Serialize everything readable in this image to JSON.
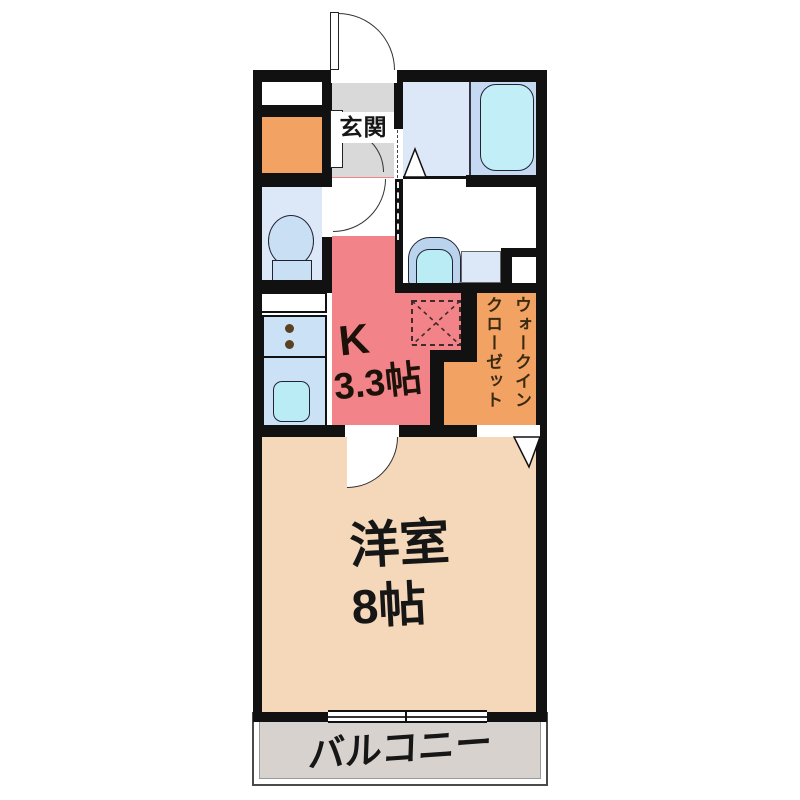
{
  "rooms": {
    "genkan": {
      "label": "玄関"
    },
    "kitchen": {
      "label_k": "K",
      "label_size": "3.3帖"
    },
    "walk_in_closet": {
      "label": "ウォークイン\nクローゼット"
    },
    "western_room": {
      "label": "洋室",
      "size": "8帖"
    },
    "balcony": {
      "label": "バルコニー"
    }
  },
  "icons": {
    "entry_door": "entry-door-swing",
    "bathtub": "bathtub",
    "toilet": "toilet",
    "washbasin": "washbasin",
    "stove": "two-burner-stove",
    "kitchen_sink": "kitchen-sink",
    "refrigerator_space": "refrigerator-space",
    "sliding_window": "sliding-window",
    "folding_door": "folding-door"
  },
  "colors": {
    "wall": "#111111",
    "kitchen_pink": "#F28389",
    "closet_orange": "#F2A263",
    "room_peach": "#F5D8BA",
    "water_blue": "#DCE8F8",
    "tub_zone_blue": "#C6D9F2",
    "tub_cyan": "#C2EFF7",
    "counter_blue": "#CBE2F6",
    "genkan_gray": "#D9D9D9",
    "balcony_gray": "#D7D2CE"
  }
}
